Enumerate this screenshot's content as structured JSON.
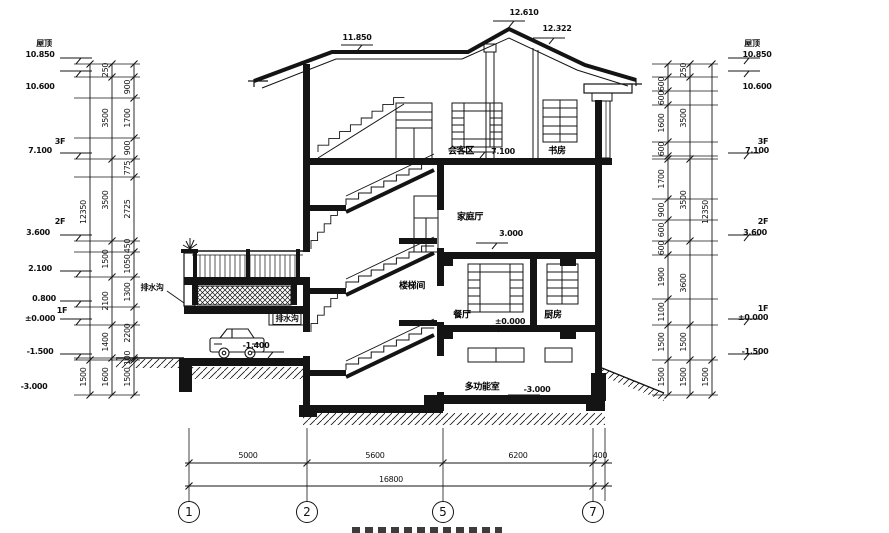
{
  "drawing": {
    "type": "architectural-section",
    "colors": {
      "ink": "#141414",
      "paper": "#ffffff"
    },
    "annotations": {
      "left_levels": [
        {
          "text": "屋顶",
          "x": 44,
          "y": 44
        },
        {
          "text": "10.850",
          "x": 40,
          "y": 55
        },
        {
          "text": "10.600",
          "x": 40,
          "y": 87
        },
        {
          "text": "3F",
          "x": 60,
          "y": 142
        },
        {
          "text": "7.100",
          "x": 40,
          "y": 151
        },
        {
          "text": "2F",
          "x": 60,
          "y": 222
        },
        {
          "text": "3.600",
          "x": 38,
          "y": 233
        },
        {
          "text": "2.100",
          "x": 40,
          "y": 269
        },
        {
          "text": "0.800",
          "x": 44,
          "y": 299
        },
        {
          "text": "1F",
          "x": 62,
          "y": 311
        },
        {
          "text": "±0.000",
          "x": 40,
          "y": 319
        },
        {
          "text": "-1.500",
          "x": 40,
          "y": 352
        },
        {
          "text": "-3.000",
          "x": 34,
          "y": 387
        }
      ],
      "right_levels": [
        {
          "text": "屋顶",
          "x": 752,
          "y": 44
        },
        {
          "text": "10.850",
          "x": 757,
          "y": 55
        },
        {
          "text": "10.600",
          "x": 757,
          "y": 87
        },
        {
          "text": "3F",
          "x": 763,
          "y": 142
        },
        {
          "text": "7.100",
          "x": 757,
          "y": 151
        },
        {
          "text": "2F",
          "x": 763,
          "y": 222
        },
        {
          "text": "3.600",
          "x": 755,
          "y": 233
        },
        {
          "text": "1F",
          "x": 763,
          "y": 309
        },
        {
          "text": "±0.000",
          "x": 753,
          "y": 318
        },
        {
          "text": "-1.500",
          "x": 755,
          "y": 352
        }
      ],
      "left_dims": [
        {
          "text": "12350",
          "x": 84,
          "y": 212
        },
        {
          "text": "1500",
          "x": 84,
          "y": 377
        },
        {
          "text": "250",
          "x": 106,
          "y": 70
        },
        {
          "text": "3500",
          "x": 106,
          "y": 118
        },
        {
          "text": "3500",
          "x": 106,
          "y": 200
        },
        {
          "text": "1500",
          "x": 106,
          "y": 259
        },
        {
          "text": "2100",
          "x": 106,
          "y": 301
        },
        {
          "text": "1400",
          "x": 106,
          "y": 342
        },
        {
          "text": "1600",
          "x": 106,
          "y": 377
        },
        {
          "text": "900",
          "x": 128,
          "y": 87
        },
        {
          "text": "1700",
          "x": 128,
          "y": 118
        },
        {
          "text": "900",
          "x": 128,
          "y": 148
        },
        {
          "text": "775",
          "x": 128,
          "y": 168
        },
        {
          "text": "2725",
          "x": 128,
          "y": 209
        },
        {
          "text": "450",
          "x": 128,
          "y": 246
        },
        {
          "text": "1050",
          "x": 128,
          "y": 264
        },
        {
          "text": "1300",
          "x": 128,
          "y": 292
        },
        {
          "text": "2200",
          "x": 128,
          "y": 333
        },
        {
          "text": "100",
          "x": 128,
          "y": 358
        },
        {
          "text": "1500",
          "x": 128,
          "y": 377
        }
      ],
      "right_dims": [
        {
          "text": "600",
          "x": 662,
          "y": 84
        },
        {
          "text": "600",
          "x": 662,
          "y": 98
        },
        {
          "text": "1600",
          "x": 662,
          "y": 123
        },
        {
          "text": "600",
          "x": 662,
          "y": 149
        },
        {
          "text": "1700",
          "x": 662,
          "y": 179
        },
        {
          "text": "900",
          "x": 662,
          "y": 210
        },
        {
          "text": "600",
          "x": 662,
          "y": 230
        },
        {
          "text": "600",
          "x": 662,
          "y": 248
        },
        {
          "text": "1900",
          "x": 662,
          "y": 277
        },
        {
          "text": "1100",
          "x": 662,
          "y": 312
        },
        {
          "text": "1500",
          "x": 662,
          "y": 342
        },
        {
          "text": "1500",
          "x": 662,
          "y": 377
        },
        {
          "text": "250",
          "x": 684,
          "y": 70
        },
        {
          "text": "3500",
          "x": 684,
          "y": 118
        },
        {
          "text": "3500",
          "x": 684,
          "y": 200
        },
        {
          "text": "3600",
          "x": 684,
          "y": 283
        },
        {
          "text": "1500",
          "x": 684,
          "y": 342
        },
        {
          "text": "1500",
          "x": 684,
          "y": 377
        },
        {
          "text": "12350",
          "x": 706,
          "y": 212
        },
        {
          "text": "1500",
          "x": 706,
          "y": 377
        }
      ],
      "bottom_dims": [
        {
          "text": "5000",
          "x": 248,
          "y": 456
        },
        {
          "text": "5600",
          "x": 375,
          "y": 456
        },
        {
          "text": "6200",
          "x": 518,
          "y": 456
        },
        {
          "text": "400",
          "x": 600,
          "y": 456
        },
        {
          "text": "16800",
          "x": 391,
          "y": 480
        }
      ],
      "rooms": [
        {
          "text": "会客区",
          "x": 461,
          "y": 152
        },
        {
          "text": "书房",
          "x": 557,
          "y": 152
        },
        {
          "text": "家庭厅",
          "x": 470,
          "y": 218
        },
        {
          "text": "楼梯间",
          "x": 412,
          "y": 287
        },
        {
          "text": "餐厅",
          "x": 462,
          "y": 316
        },
        {
          "text": "厨房",
          "x": 553,
          "y": 316
        },
        {
          "text": "多功能室",
          "x": 482,
          "y": 388
        }
      ],
      "inner_levels": [
        {
          "text": "11.850",
          "x": 357,
          "y": 38
        },
        {
          "text": "12.610",
          "x": 524,
          "y": 13
        },
        {
          "text": "12.322",
          "x": 557,
          "y": 29
        },
        {
          "text": "7.100",
          "x": 503,
          "y": 152
        },
        {
          "text": "3.000",
          "x": 511,
          "y": 234
        },
        {
          "text": "±0.000",
          "x": 510,
          "y": 322
        },
        {
          "text": "-1.400",
          "x": 256,
          "y": 346
        },
        {
          "text": "-3.000",
          "x": 537,
          "y": 390
        }
      ],
      "misc_labels": [
        {
          "text": "排水沟",
          "x": 152,
          "y": 288
        },
        {
          "text": "排水沟",
          "x": 287,
          "y": 319,
          "boxed": true
        }
      ],
      "axis": {
        "y": 512,
        "bubbles": [
          {
            "text": "1",
            "x": 189
          },
          {
            "text": "2",
            "x": 307
          },
          {
            "text": "5",
            "x": 443
          },
          {
            "text": "7",
            "x": 593
          }
        ]
      }
    }
  }
}
